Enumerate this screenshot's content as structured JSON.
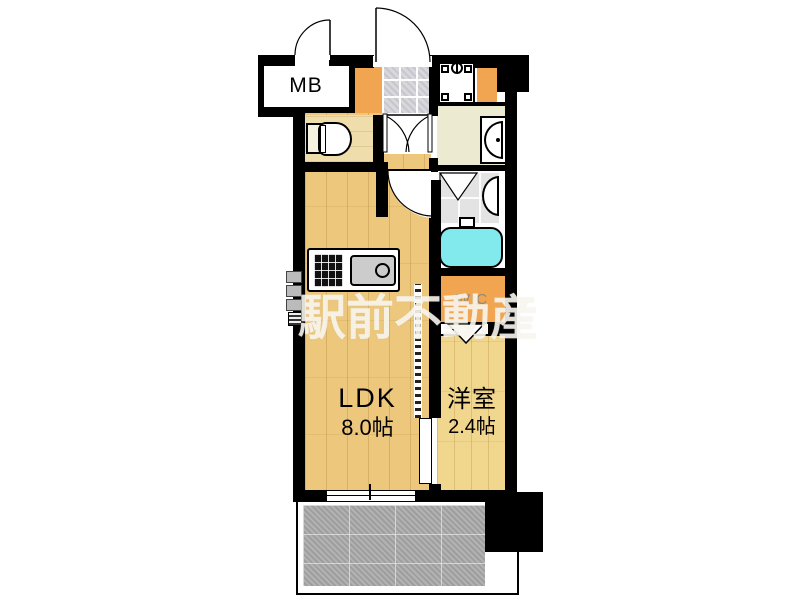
{
  "watermark": "駅前不動産",
  "labels": {
    "meter_box": "MB",
    "walk_in_closet": "WIC",
    "ldk_name": "LDK",
    "ldk_size": "8.0帖",
    "western_room_name": "洋室",
    "western_room_size": "2.4帖"
  },
  "rooms": [
    {
      "name": "LDK",
      "size": "8.0帖",
      "floor": "wood"
    },
    {
      "name": "洋室",
      "size": "2.4帖",
      "floor": "wood"
    },
    {
      "name": "WIC",
      "floor": "closet"
    },
    {
      "name": "MB",
      "floor": "meter-box"
    },
    {
      "name": "バルコニー",
      "floor": "concrete-tile"
    }
  ],
  "fixtures": [
    "toilet",
    "kitchen-counter",
    "stove",
    "kitchen-sink",
    "washbasin",
    "bathtub",
    "bathroom-counter",
    "washing-machine-pan",
    "entrance-tile"
  ],
  "colors": {
    "wall": "#000000",
    "ldk_floor": "#ecc77c",
    "western_floor": "#f1d68e",
    "closet_orange": "#f2a550",
    "washroom_cream": "#ecead0",
    "bathtub_cyan": "#82e9ec",
    "balcony_gray": "#aaaaaa",
    "entry_tile_gray": "#d7d7dc",
    "watermark_color": "rgba(252,250,243,0.82)"
  }
}
